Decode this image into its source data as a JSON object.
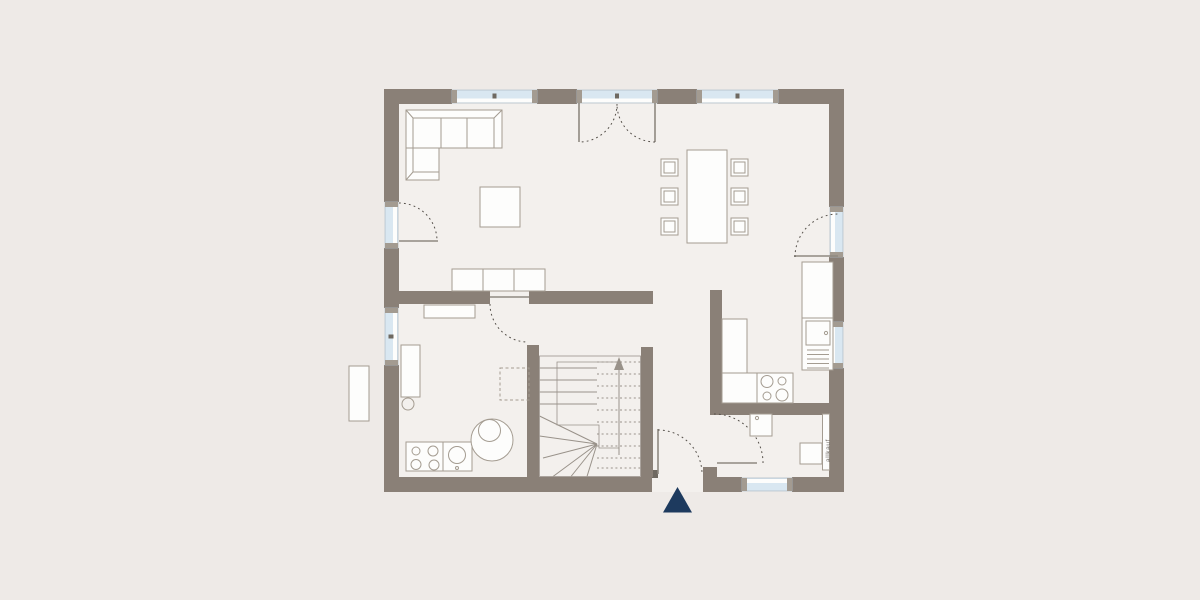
{
  "watermark": {
    "text": "allkauf"
  },
  "palette": {
    "background_outer": "#eeeae7",
    "floor": "#f3f0ed",
    "wall": "#8a8077",
    "window_glass": "#d9e7f1",
    "window_frame": "#aebbc4",
    "window_marker": "#a39b91",
    "window_mullion": "#6f6961",
    "door_leaf": "#8f8981",
    "door_arc": "#55504a",
    "furniture_stroke": "#a49c91",
    "furniture_fill": "#fdfdfc",
    "stair_line": "#99928a",
    "entrance_arrow": "#1d3a5e",
    "watermark_color": "#6b655e"
  }
}
